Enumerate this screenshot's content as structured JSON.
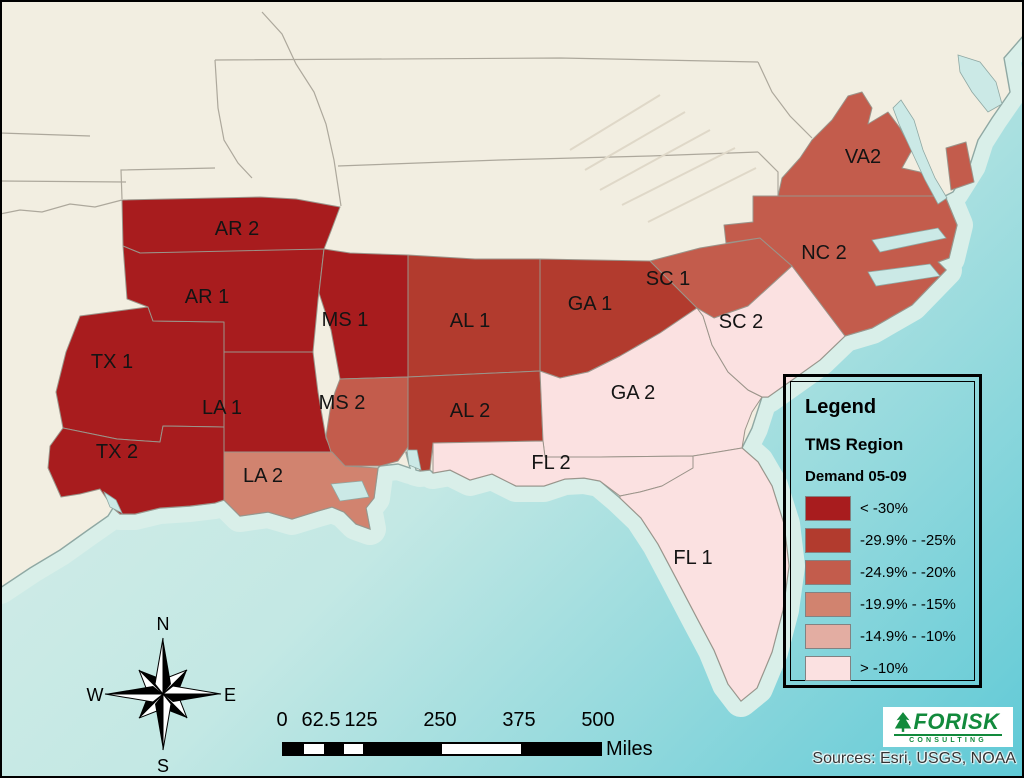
{
  "map": {
    "land_color": "#F2EEE1",
    "ocean_shallow": "#D9EFE9",
    "ocean_deep": "#5FC9D6",
    "regions": [
      {
        "id": "ar2",
        "label": "AR 2",
        "demand_class": "< -30%",
        "color": "#A81C1E"
      },
      {
        "id": "ar1",
        "label": "AR 1",
        "demand_class": "< -30%",
        "color": "#A81C1E"
      },
      {
        "id": "tx1",
        "label": "TX 1",
        "demand_class": "< -30%",
        "color": "#A81C1E"
      },
      {
        "id": "tx2",
        "label": "TX 2",
        "demand_class": "< -30%",
        "color": "#A81C1E"
      },
      {
        "id": "la1",
        "label": "LA 1",
        "demand_class": "< -30%",
        "color": "#A81C1E"
      },
      {
        "id": "ms1",
        "label": "MS 1",
        "demand_class": "< -30%",
        "color": "#A81C1E"
      },
      {
        "id": "ms2",
        "label": "MS 2",
        "demand_class": "-24.9% - -20%",
        "color": "#C35C4C"
      },
      {
        "id": "la2",
        "label": "LA 2",
        "demand_class": "-19.9% - -15%",
        "color": "#D1836F"
      },
      {
        "id": "al1",
        "label": "AL 1",
        "demand_class": "-29.9% - -25%",
        "color": "#B23B2E"
      },
      {
        "id": "al2",
        "label": "AL 2",
        "demand_class": "-29.9% - -25%",
        "color": "#B23B2E"
      },
      {
        "id": "ga1",
        "label": "GA 1",
        "demand_class": "-29.9% - -25%",
        "color": "#B23B2E"
      },
      {
        "id": "ga2",
        "label": "GA 2",
        "demand_class": "> -10%",
        "color": "#FBE1E1"
      },
      {
        "id": "sc1",
        "label": "SC 1",
        "demand_class": "-24.9% - -20%",
        "color": "#C35C4C"
      },
      {
        "id": "sc2",
        "label": "SC 2",
        "demand_class": "> -10%",
        "color": "#FBE1E1"
      },
      {
        "id": "nc2",
        "label": "NC 2",
        "demand_class": "-24.9% - -20%",
        "color": "#C35C4C"
      },
      {
        "id": "va2",
        "label": "VA2",
        "demand_class": "-24.9% - -20%",
        "color": "#C35C4C"
      },
      {
        "id": "fl2",
        "label": "FL 2",
        "demand_class": "> -10%",
        "color": "#FBE1E1"
      },
      {
        "id": "fl1",
        "label": "FL 1",
        "demand_class": "> -10%",
        "color": "#FBE1E1"
      }
    ]
  },
  "legend": {
    "title": "Legend",
    "layer": "TMS Region",
    "field": "Demand 05-09",
    "classes": [
      {
        "label": "< -30%",
        "color": "#A81C1E"
      },
      {
        "label": "-29.9% - -25%",
        "color": "#B23B2E"
      },
      {
        "label": "-24.9% - -20%",
        "color": "#C35C4C"
      },
      {
        "label": "-19.9% - -15%",
        "color": "#D1836F"
      },
      {
        "label": "-14.9% - -10%",
        "color": "#E3ADA2"
      },
      {
        "label": "> -10%",
        "color": "#FBE1E1"
      }
    ]
  },
  "scalebar": {
    "ticks": [
      "0",
      "62.5",
      "125",
      "250",
      "375",
      "500"
    ],
    "unit": "Miles"
  },
  "compass": {
    "n": "N",
    "e": "E",
    "s": "S",
    "w": "W"
  },
  "logo": {
    "brand": "FORISK",
    "tagline": "CONSULTING"
  },
  "credits": "Sources: Esri, USGS, NOAA"
}
